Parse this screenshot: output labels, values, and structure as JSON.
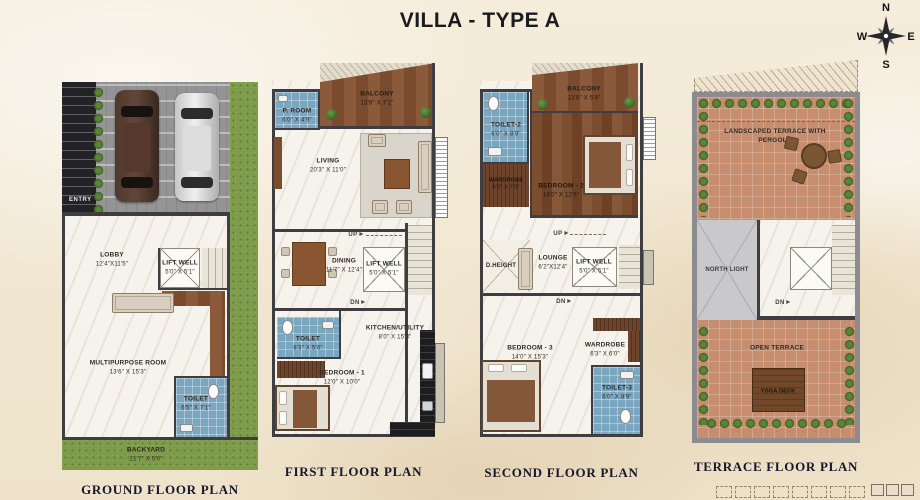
{
  "title": "VILLA - TYPE A",
  "compass": {
    "north": "N",
    "east": "E",
    "south": "S",
    "west": "W"
  },
  "colors": {
    "paper": "#f2e8d5",
    "wall": "#3e3d42",
    "tile_blue": "#7ba6bf",
    "wood": "#7a4b2e",
    "grass": "#7e9c4b",
    "terracotta": "#c68e6f",
    "title_ink": "#17172c"
  },
  "ground": {
    "title": "GROUND FLOOR PLAN",
    "entry": "ENTRY",
    "lobby": {
      "name": "LOBBY",
      "dims": "12'4\"X11'5\""
    },
    "lift": {
      "name": "LIFT WELL",
      "dims": "5'0\" X 5'1\""
    },
    "multipurpose": {
      "name": "MULTIPURPOSE ROOM",
      "dims": "13'6\" X 15'3\""
    },
    "toilet": {
      "name": "TOILET",
      "dims": "6'5\" X 7'1\""
    },
    "backyard": {
      "name": "BACKYARD",
      "dims": "21'7\" X 5'0\""
    }
  },
  "first": {
    "title": "FIRST FLOOR PLAN",
    "up": "UP",
    "dn": "DN",
    "proom": {
      "name": "P. ROOM",
      "dims": "6'0\" X 4'9\""
    },
    "balcony": {
      "name": "BALCONY",
      "dims": "13'8\" X 7'2\""
    },
    "living": {
      "name": "LIVING",
      "dims": "20'3\" X 11'0\""
    },
    "dining": {
      "name": "DINING",
      "dims": "11'7\" X 12'4\""
    },
    "lift": {
      "name": "LIFT WELL",
      "dims": "5'0\" X 5'1\""
    },
    "toilet": {
      "name": "TOILET",
      "dims": "8'3\" X 5'0\""
    },
    "kitchen": {
      "name": "KITCHEN/UTILITY",
      "dims": "8'0\" X 15'3\""
    },
    "bedroom1": {
      "name": "BEDROOM - 1",
      "dims": "12'0\" X 10'0\""
    }
  },
  "second": {
    "title": "SECOND FLOOR PLAN",
    "up": "UP",
    "dn": "DN",
    "toilet2": {
      "name": "TOILET-2",
      "dims": "6'0\" X 8'9\""
    },
    "balcony": {
      "name": "BALCONY",
      "dims": "13'8\" X 5'8\""
    },
    "bedroom2": {
      "name": "BEDROOM - 2",
      "dims": "14'0\" X 12'6\""
    },
    "wardrobe2": {
      "name": "WARDROBE",
      "dims": "6'0\" X 7'0\""
    },
    "dheight": "D.HEIGHT",
    "lounge": {
      "name": "LOUNGE",
      "dims": "6'2\"X12'4\""
    },
    "lift": {
      "name": "LIFT WELL",
      "dims": "5'0\" X 5'1\""
    },
    "bedroom3": {
      "name": "BEDROOM - 3",
      "dims": "14'0\" X 15'3\""
    },
    "wardrobe3": {
      "name": "WARDROBE",
      "dims": "6'3\" X 6'0\""
    },
    "toilet3": {
      "name": "TOILET-3",
      "dims": "6'0\" X 8'9\""
    }
  },
  "terrace": {
    "title": "TERRACE FLOOR PLAN",
    "landscaped": "LANDSCAPED TERRACE WITH PERGOLA",
    "northlight": "NORTH LIGHT",
    "dn": "DN",
    "open": "OPEN TERRACE",
    "yoga": "YOGA DECK"
  }
}
